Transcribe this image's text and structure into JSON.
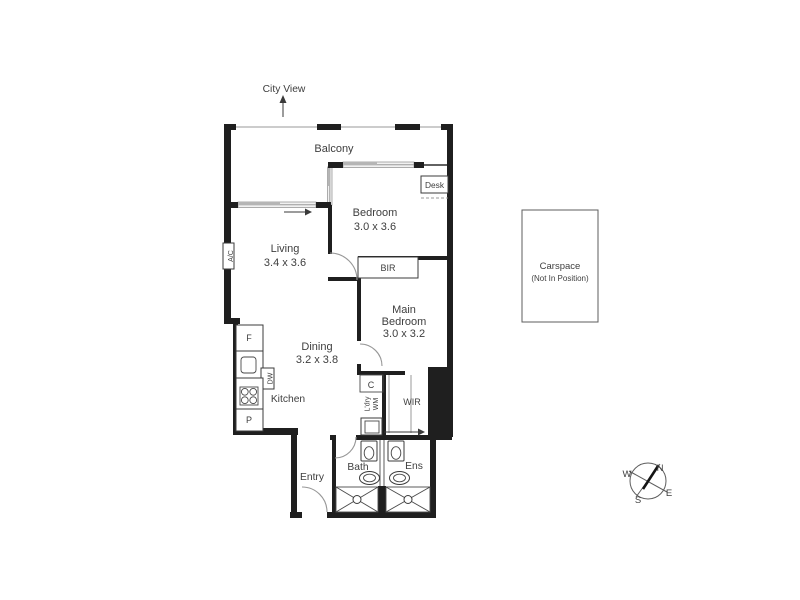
{
  "annotations": {
    "city_view": "City View"
  },
  "rooms": {
    "balcony": {
      "label": "Balcony"
    },
    "bedroom": {
      "label": "Bedroom",
      "dimensions": "3.0 x 3.6"
    },
    "living": {
      "label": "Living",
      "dimensions": "3.4 x 3.6"
    },
    "main_bedroom": {
      "label_line1": "Main",
      "label_line2": "Bedroom",
      "dimensions": "3.0 x 3.2"
    },
    "dining": {
      "label": "Dining",
      "dimensions": "3.2 x 3.8"
    },
    "kitchen": {
      "label": "Kitchen"
    },
    "entry": {
      "label": "Entry"
    },
    "bath": {
      "label": "Bath"
    },
    "ensuite": {
      "label": "Ens"
    },
    "wir": {
      "label": "WIR"
    },
    "bir": {
      "label": "BIR"
    }
  },
  "fixtures": {
    "air_conditioner": "A/C",
    "fridge": "F",
    "dishwasher": "DW",
    "pantry": "P",
    "cupboard": "C",
    "laundry_line1": "L'dry",
    "laundry_line2": "WM",
    "desk": "Desk"
  },
  "carspace": {
    "label": "Carspace",
    "note": "(Not In Position)"
  },
  "compass": {
    "north": "N",
    "south": "S",
    "east": "E",
    "west": "W"
  },
  "colors": {
    "wall": "#1f1f1f",
    "text": "#3e3e3e",
    "window_fill": "#f1f1f1",
    "window_panel": "#b5b5b5",
    "door_arc": "#979797",
    "background": "#ffffff"
  }
}
